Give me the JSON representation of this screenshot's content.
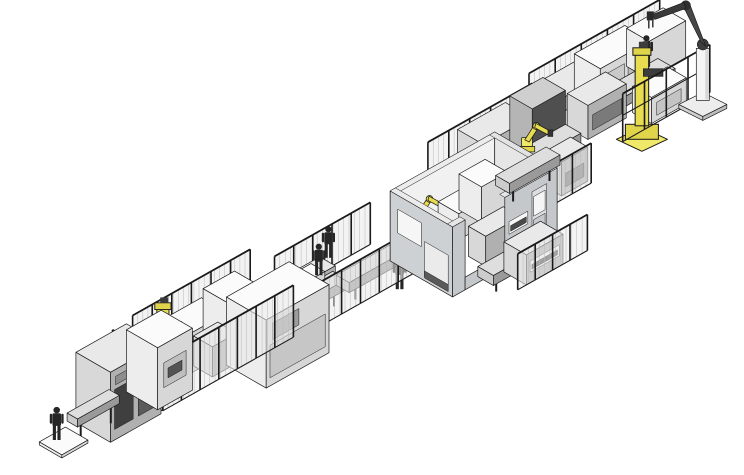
{
  "scene": {
    "canvas": {
      "w": 744,
      "h": 475
    },
    "background": "#ffffff",
    "origin": {
      "x": 48,
      "y": 436
    },
    "axis_a": {
      "x": 0.871,
      "y": -0.491
    },
    "axis_b": {
      "x": 0.866,
      "y": 0.5
    },
    "stroke": "#1c1c1c",
    "operator_color": "#262626",
    "accent_yellow": "#e0d54a",
    "palettes": {
      "W": {
        "top": "#fbfbfb",
        "sw": "#ededed",
        "se": "#d7d7d7"
      },
      "G": {
        "top": "#e9e9e9",
        "sw": "#d8d8d8",
        "se": "#b0b0b0"
      },
      "C": {
        "top": "#dedede",
        "sw": "#cccccc",
        "se": "#9a9a9a"
      },
      "D": {
        "top": "#cfcfcf",
        "sw": "#b5b5b5",
        "se": "#4f4f4f"
      },
      "Y": {
        "top": "#f0e868",
        "sw": "#e0d54a",
        "se": "#c0b32e"
      }
    },
    "yellow": {
      "top": "#f0e868",
      "sw": "#e0d54a",
      "mast": "#e8dd50"
    },
    "items": [
      {
        "type": "fence",
        "name": "rear-fence-top-right",
        "u": 600,
        "v": -48,
        "len": 150,
        "h": 44,
        "axis": "a",
        "posts": 5
      },
      {
        "type": "box",
        "name": "cabinet-top-right-rear-1",
        "u": 598,
        "v": -42,
        "w": 48,
        "d": 30,
        "h": 36,
        "pal": "G",
        "seIns": [
          [
            0.1,
            0.2,
            0.9,
            0.6,
            "#6d6d6d"
          ]
        ]
      },
      {
        "type": "box",
        "name": "cabinet-top-right-rear-2",
        "u": 648,
        "v": -44,
        "w": 58,
        "d": 30,
        "h": 42,
        "pal": "W",
        "seIns": [
          [
            0.08,
            0.15,
            0.48,
            0.8,
            "#c9c9c9"
          ],
          [
            0.55,
            0.15,
            0.92,
            0.8,
            "#bdbdbd"
          ]
        ]
      },
      {
        "type": "box",
        "name": "cabinet-top-right-rear-3",
        "u": 708,
        "v": -44,
        "w": 42,
        "d": 26,
        "h": 38,
        "pal": "W"
      },
      {
        "type": "box",
        "name": "conveyor-top-right",
        "u": 575,
        "v": -10,
        "w": 135,
        "d": 20,
        "h": 10,
        "z0": 14,
        "pal": "C",
        "legs": true
      },
      {
        "type": "box",
        "name": "machine-top-right-mid",
        "u": 612,
        "v": -16,
        "w": 44,
        "d": 24,
        "h": 34,
        "pal": "G",
        "seIns": [
          [
            0.12,
            0.2,
            0.88,
            0.65,
            "#7a7a7a"
          ]
        ]
      },
      {
        "type": "operator",
        "name": "operator-top-right",
        "u": 695,
        "v": -8,
        "z": 24,
        "s": 1.0
      },
      {
        "type": "box",
        "name": "machine-top-right-front",
        "u": 665,
        "v": 6,
        "w": 40,
        "d": 22,
        "h": 26,
        "pal": "W",
        "seIns": [
          [
            0.15,
            0.2,
            0.85,
            0.7,
            "#c4c4c4"
          ]
        ]
      },
      {
        "type": "mastRobot",
        "name": "yellow-robot-top-right",
        "u": 648,
        "v": 34,
        "z": 0,
        "s": 1.5
      },
      {
        "type": "fence",
        "name": "front-frames-top-right",
        "u": 630,
        "v": 30,
        "len": 100,
        "h": 48,
        "axis": "a",
        "posts": 4,
        "mesh": false
      },
      {
        "type": "pedestalRobot",
        "name": "pedestal-robot-top-right",
        "u": 714,
        "v": 38
      },
      {
        "type": "fence",
        "name": "rear-fence-right-mid",
        "u": 470,
        "v": -34,
        "len": 120,
        "h": 46,
        "axis": "a",
        "posts": 5
      },
      {
        "type": "box",
        "name": "cabinet-right-mid-rear-1",
        "u": 500,
        "v": -30,
        "w": 55,
        "d": 30,
        "h": 46,
        "pal": "G",
        "seIns": [
          [
            0.1,
            0.2,
            0.55,
            0.75,
            "#6a6a6a"
          ],
          [
            0.62,
            0.25,
            0.9,
            0.7,
            "#8b8b8b"
          ]
        ]
      },
      {
        "type": "box",
        "name": "cabinet-right-mid-rear-2",
        "u": 558,
        "v": -28,
        "w": 38,
        "d": 26,
        "h": 52,
        "pal": "D"
      },
      {
        "type": "box",
        "name": "conveyor-right-mid",
        "u": 470,
        "v": 4,
        "w": 120,
        "d": 18,
        "h": 10,
        "z0": 14,
        "pal": "C",
        "legs": true
      },
      {
        "type": "armRobot",
        "name": "yellow-robot-right-mid",
        "u": 540,
        "v": 10,
        "z": 24,
        "s": 1.1
      },
      {
        "type": "box",
        "name": "machine-right-mid-front-1",
        "u": 495,
        "v": 28,
        "w": 34,
        "d": 22,
        "h": 30,
        "pal": "W",
        "seIns": [
          [
            0.15,
            0.25,
            0.85,
            0.7,
            "#c7c7c7"
          ]
        ]
      },
      {
        "type": "box",
        "name": "machine-right-mid-front-2",
        "u": 540,
        "v": 30,
        "w": 30,
        "d": 20,
        "h": 34,
        "pal": "G",
        "seIns": [
          [
            0.15,
            0.2,
            0.85,
            0.6,
            "#6f6f6f"
          ]
        ]
      },
      {
        "type": "fence",
        "name": "front-fence-right-mid",
        "u": 462,
        "v": 54,
        "len": 108,
        "h": 40,
        "axis": "a",
        "posts": 5
      },
      {
        "type": "fence",
        "name": "rear-fence-mid",
        "u": 270,
        "v": -10,
        "len": 110,
        "h": 42,
        "axis": "a",
        "posts": 5
      },
      {
        "type": "box",
        "name": "bench-mid-rear-1",
        "u": 252,
        "v": -4,
        "w": 30,
        "d": 20,
        "h": 28,
        "pal": "W"
      },
      {
        "type": "box",
        "name": "bench-mid-rear-2",
        "u": 288,
        "v": -2,
        "w": 26,
        "d": 18,
        "h": 24,
        "pal": "G"
      },
      {
        "type": "box",
        "name": "conveyor-mid-1",
        "u": 232,
        "v": 20,
        "w": 75,
        "d": 16,
        "h": 10,
        "z0": 14,
        "pal": "C",
        "legs": true
      },
      {
        "type": "box",
        "name": "workpiece-box-mid-1",
        "u": 262,
        "v": 18,
        "w": 22,
        "d": 16,
        "h": 18,
        "z0": 24,
        "pal": "W"
      },
      {
        "type": "operator",
        "name": "operator-mid-1",
        "u": 295,
        "v": 16,
        "z": 24,
        "s": 1.0
      },
      {
        "type": "operator",
        "name": "operator-mid-2",
        "u": 316,
        "v": 6,
        "z": 26,
        "s": 1.0
      },
      {
        "type": "box",
        "name": "conveyor-mid-2",
        "u": 305,
        "v": 26,
        "w": 78,
        "d": 15,
        "h": 10,
        "z0": 14,
        "pal": "C",
        "legs": true
      },
      {
        "type": "operator",
        "name": "operator-mid-3",
        "u": 352,
        "v": 52,
        "z": 0,
        "s": 1.05
      },
      {
        "type": "fence",
        "name": "front-fence-mid",
        "u": 250,
        "v": 44,
        "len": 130,
        "h": 44,
        "axis": "a",
        "posts": 6
      },
      {
        "type": "fence",
        "name": "rear-fence-left-cell",
        "u": 115,
        "v": -18,
        "len": 135,
        "h": 55,
        "axis": "a",
        "posts": 6
      },
      {
        "type": "box",
        "name": "cabinet-left-cell-rear-1",
        "u": 148,
        "v": -12,
        "w": 40,
        "d": 30,
        "h": 40,
        "pal": "W"
      },
      {
        "type": "box",
        "name": "cabinet-left-cell-rear-2",
        "u": 192,
        "v": -14,
        "w": 36,
        "d": 28,
        "h": 46,
        "pal": "W",
        "seIns": [
          [
            0.15,
            0.25,
            0.85,
            0.75,
            "#cfcfcf"
          ]
        ]
      },
      {
        "type": "mastRobot",
        "name": "yellow-robot-left-cell",
        "u": 122,
        "v": 10,
        "z": 0,
        "s": 1.35
      },
      {
        "type": "box",
        "name": "machine-left-cell",
        "u": 155,
        "v": 12,
        "w": 28,
        "d": 22,
        "h": 30,
        "pal": "G"
      },
      {
        "type": "box",
        "name": "machine-housing-left-center",
        "u": 175,
        "v": 30,
        "w": 72,
        "d": 46,
        "h": 68,
        "pal": "W",
        "seIns": [
          [
            0.06,
            0.12,
            0.94,
            0.6,
            "#c6c6c6"
          ],
          [
            0.1,
            0.66,
            0.52,
            0.9,
            "#9c9c9c"
          ]
        ]
      },
      {
        "type": "fence",
        "name": "front-fence-left-cell",
        "u": 92,
        "v": 40,
        "len": 150,
        "h": 52,
        "axis": "a",
        "posts": 7
      },
      {
        "type": "fence",
        "name": "side-fence-left-cell",
        "u": 92,
        "v": -18,
        "len": 58,
        "h": 52,
        "axis": "b",
        "posts": 3
      },
      {
        "type": "box",
        "name": "cabinet-far-left-1",
        "u": 30,
        "v": 2,
        "w": 58,
        "d": 40,
        "h": 70,
        "pal": "G",
        "seIns": [
          [
            0.08,
            0.15,
            0.45,
            0.72,
            "#3f3f3f"
          ],
          [
            0.55,
            0.15,
            0.92,
            0.72,
            "#5a5a5a"
          ],
          [
            0.1,
            0.78,
            0.9,
            0.9,
            "#8d8d8d"
          ]
        ]
      },
      {
        "type": "box",
        "name": "cabinet-far-left-2",
        "u": 90,
        "v": 0,
        "w": 40,
        "d": 36,
        "h": 62,
        "pal": "W",
        "seIns": [
          [
            0.18,
            0.3,
            0.82,
            0.7,
            "#bfbfbf"
          ],
          [
            0.3,
            0.42,
            0.7,
            0.58,
            "#545454"
          ]
        ]
      },
      {
        "type": "box",
        "name": "infeed-conveyor",
        "u": 8,
        "v": 14,
        "w": 48,
        "d": 12,
        "h": 8,
        "z0": 18,
        "pal": "C",
        "legs": true
      },
      {
        "type": "box",
        "name": "operator-base-plate",
        "u": -14,
        "v": 4,
        "w": 30,
        "d": 26,
        "h": 3,
        "pal": "W"
      },
      {
        "type": "operator",
        "name": "operator-infeed",
        "u": -2,
        "v": 12,
        "z": 3,
        "s": 1.05
      },
      {
        "type": "room",
        "name": "process-enclosure-room",
        "u": 375,
        "v": 18,
        "w": 120,
        "d": 72,
        "h": 70,
        "t": 6,
        "sw_ins": [
          [
            0.12,
            0.46,
            0.5,
            0.8,
            "#f6f6f6"
          ],
          [
            0.55,
            0.06,
            0.93,
            0.56,
            "#ebebeb"
          ],
          [
            0.55,
            0.04,
            0.93,
            0.14,
            "#5a5a5a"
          ]
        ],
        "se_segments": [
          [
            0,
            0.12,
            0,
            1
          ],
          [
            0.12,
            0.5,
            0,
            0.18
          ],
          [
            0.5,
            1,
            0,
            1
          ]
        ],
        "se_ins": [
          [
            0.54,
            0.44,
            0.72,
            0.62,
            "#f6f6f6"
          ],
          [
            0.555,
            0.47,
            0.705,
            0.55,
            "#4a4a4a"
          ],
          [
            0.54,
            0.16,
            0.72,
            0.3,
            "#f0f0f0"
          ],
          [
            0.76,
            0.04,
            0.9,
            0.86,
            "#dcdfe1"
          ],
          [
            0.775,
            0.5,
            0.885,
            0.78,
            "#f5f5f5"
          ],
          [
            0.775,
            0.12,
            0.885,
            0.45,
            "#c6c9cb"
          ]
        ],
        "interior": [
          {
            "type": "box",
            "name": "room-interior-pedestal",
            "u": 380,
            "v": 30,
            "w": 22,
            "d": 18,
            "h": 40,
            "pal": "W"
          },
          {
            "type": "armRobot",
            "name": "yellow-robot-room-interior",
            "u": 390,
            "v": 38,
            "z": 40,
            "s": 1.05
          },
          {
            "type": "box",
            "name": "room-interior-cube-1",
            "u": 418,
            "v": 30,
            "w": 26,
            "d": 24,
            "h": 26,
            "z0": 18,
            "pal": "W"
          },
          {
            "type": "box",
            "name": "room-interior-cube-2",
            "u": 448,
            "v": 24,
            "w": 30,
            "d": 26,
            "h": 36,
            "z0": 18,
            "pal": "W"
          },
          {
            "type": "box",
            "name": "room-interior-machine",
            "u": 425,
            "v": 58,
            "w": 40,
            "d": 20,
            "h": 30,
            "pal": "G"
          }
        ]
      },
      {
        "type": "box",
        "name": "conveyor-room-front",
        "u": 398,
        "v": 96,
        "w": 55,
        "d": 18,
        "h": 10,
        "z0": 12,
        "pal": "C",
        "legs": true
      },
      {
        "type": "box",
        "name": "machine-room-front",
        "u": 430,
        "v": 94,
        "w": 42,
        "d": 26,
        "h": 30,
        "pal": "G",
        "seIns": [
          [
            0.1,
            0.35,
            0.9,
            0.72,
            "#f4f4f4"
          ],
          [
            0.15,
            0.42,
            0.85,
            0.58,
            "#474747"
          ]
        ]
      },
      {
        "type": "fence",
        "name": "front-fence-room",
        "u": 420,
        "v": 120,
        "len": 80,
        "h": 36,
        "axis": "a",
        "posts": 4
      },
      {
        "type": "box",
        "name": "conveyor-room-exit",
        "u": 498,
        "v": 16,
        "w": 58,
        "d": 16,
        "h": 10,
        "z0": 14,
        "pal": "C",
        "legs": true
      }
    ]
  }
}
